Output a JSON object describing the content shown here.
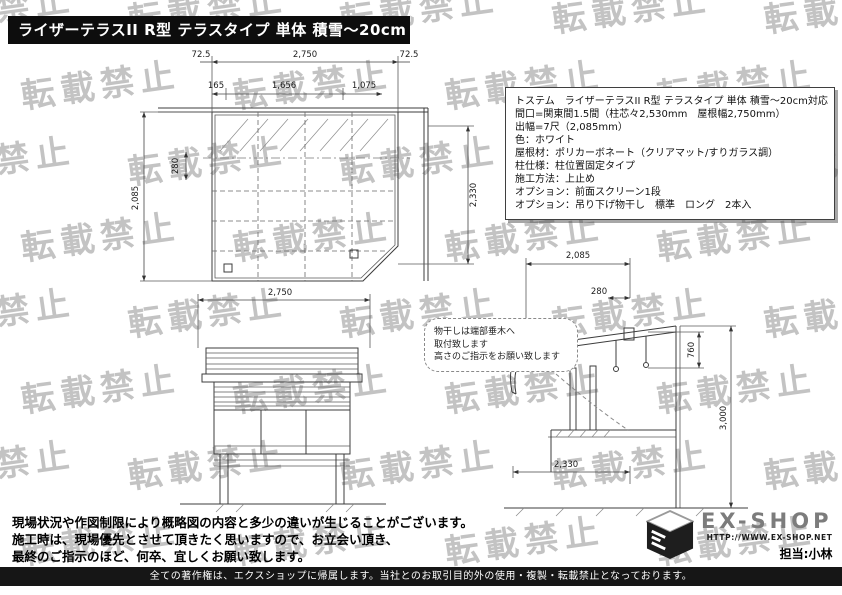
{
  "watermark": {
    "text": "転載禁止"
  },
  "title_banner": "ライザーテラスII  R型 テラスタイプ 単体 積雪～20cm対応",
  "spec_box": {
    "lines": [
      "トステム　ライザーテラスII  R型 テラスタイプ 単体 積雪～20cm対応",
      "間口=関東間1.5間（柱芯々2,530mm　屋根幅2,750mm）",
      "出幅=7尺（2,085mm）",
      "色：ホワイト",
      "屋根材：ポリカーボネート（クリアマット/すりガラス調）",
      "柱仕様：柱位置固定タイプ",
      "施工方法：上止め",
      "オプション：前面スクリーン1段",
      "オプション：吊り下げ物干し　標準　ロング　2本入"
    ]
  },
  "plan_view": {
    "dims": {
      "overhang_left": "72.5",
      "width": "2,750",
      "overhang_right": "72.5",
      "seg_a": "165",
      "seg_b": "1,656",
      "seg_c": "1,075",
      "depth": "2,085",
      "wall_offset": "280",
      "side_depth": "2,330"
    }
  },
  "front_view": {
    "dims": {
      "width": "2,750"
    }
  },
  "side_view": {
    "dims": {
      "depth": "2,085",
      "eave_offset": "280",
      "pole_drop": "760",
      "total_height": "3,000",
      "floor_depth": "2,330"
    }
  },
  "note_bubble": {
    "lines": [
      "物干しは端部垂木へ",
      "取付致します",
      "高さのご指示をお願い致します"
    ]
  },
  "site_note": {
    "lines": [
      "現場状況や作図制限により概略図の内容と多少の違いが生じることがございます。",
      "施工時は、現場優先とさせて頂きたく思いますので、お立会い頂き、",
      "最終のご指示のほど、何卒、宜しくお願い致します。"
    ]
  },
  "logo": {
    "name": "EX-SHOP",
    "url": "HTTP://WWW.EX-SHOP.NET",
    "staff": "担当:小林"
  },
  "copyright_bar": "全ての著作権は、エクスショップに帰属します。当社とのお取引目的外の使用・複製・転載禁止となっております。"
}
